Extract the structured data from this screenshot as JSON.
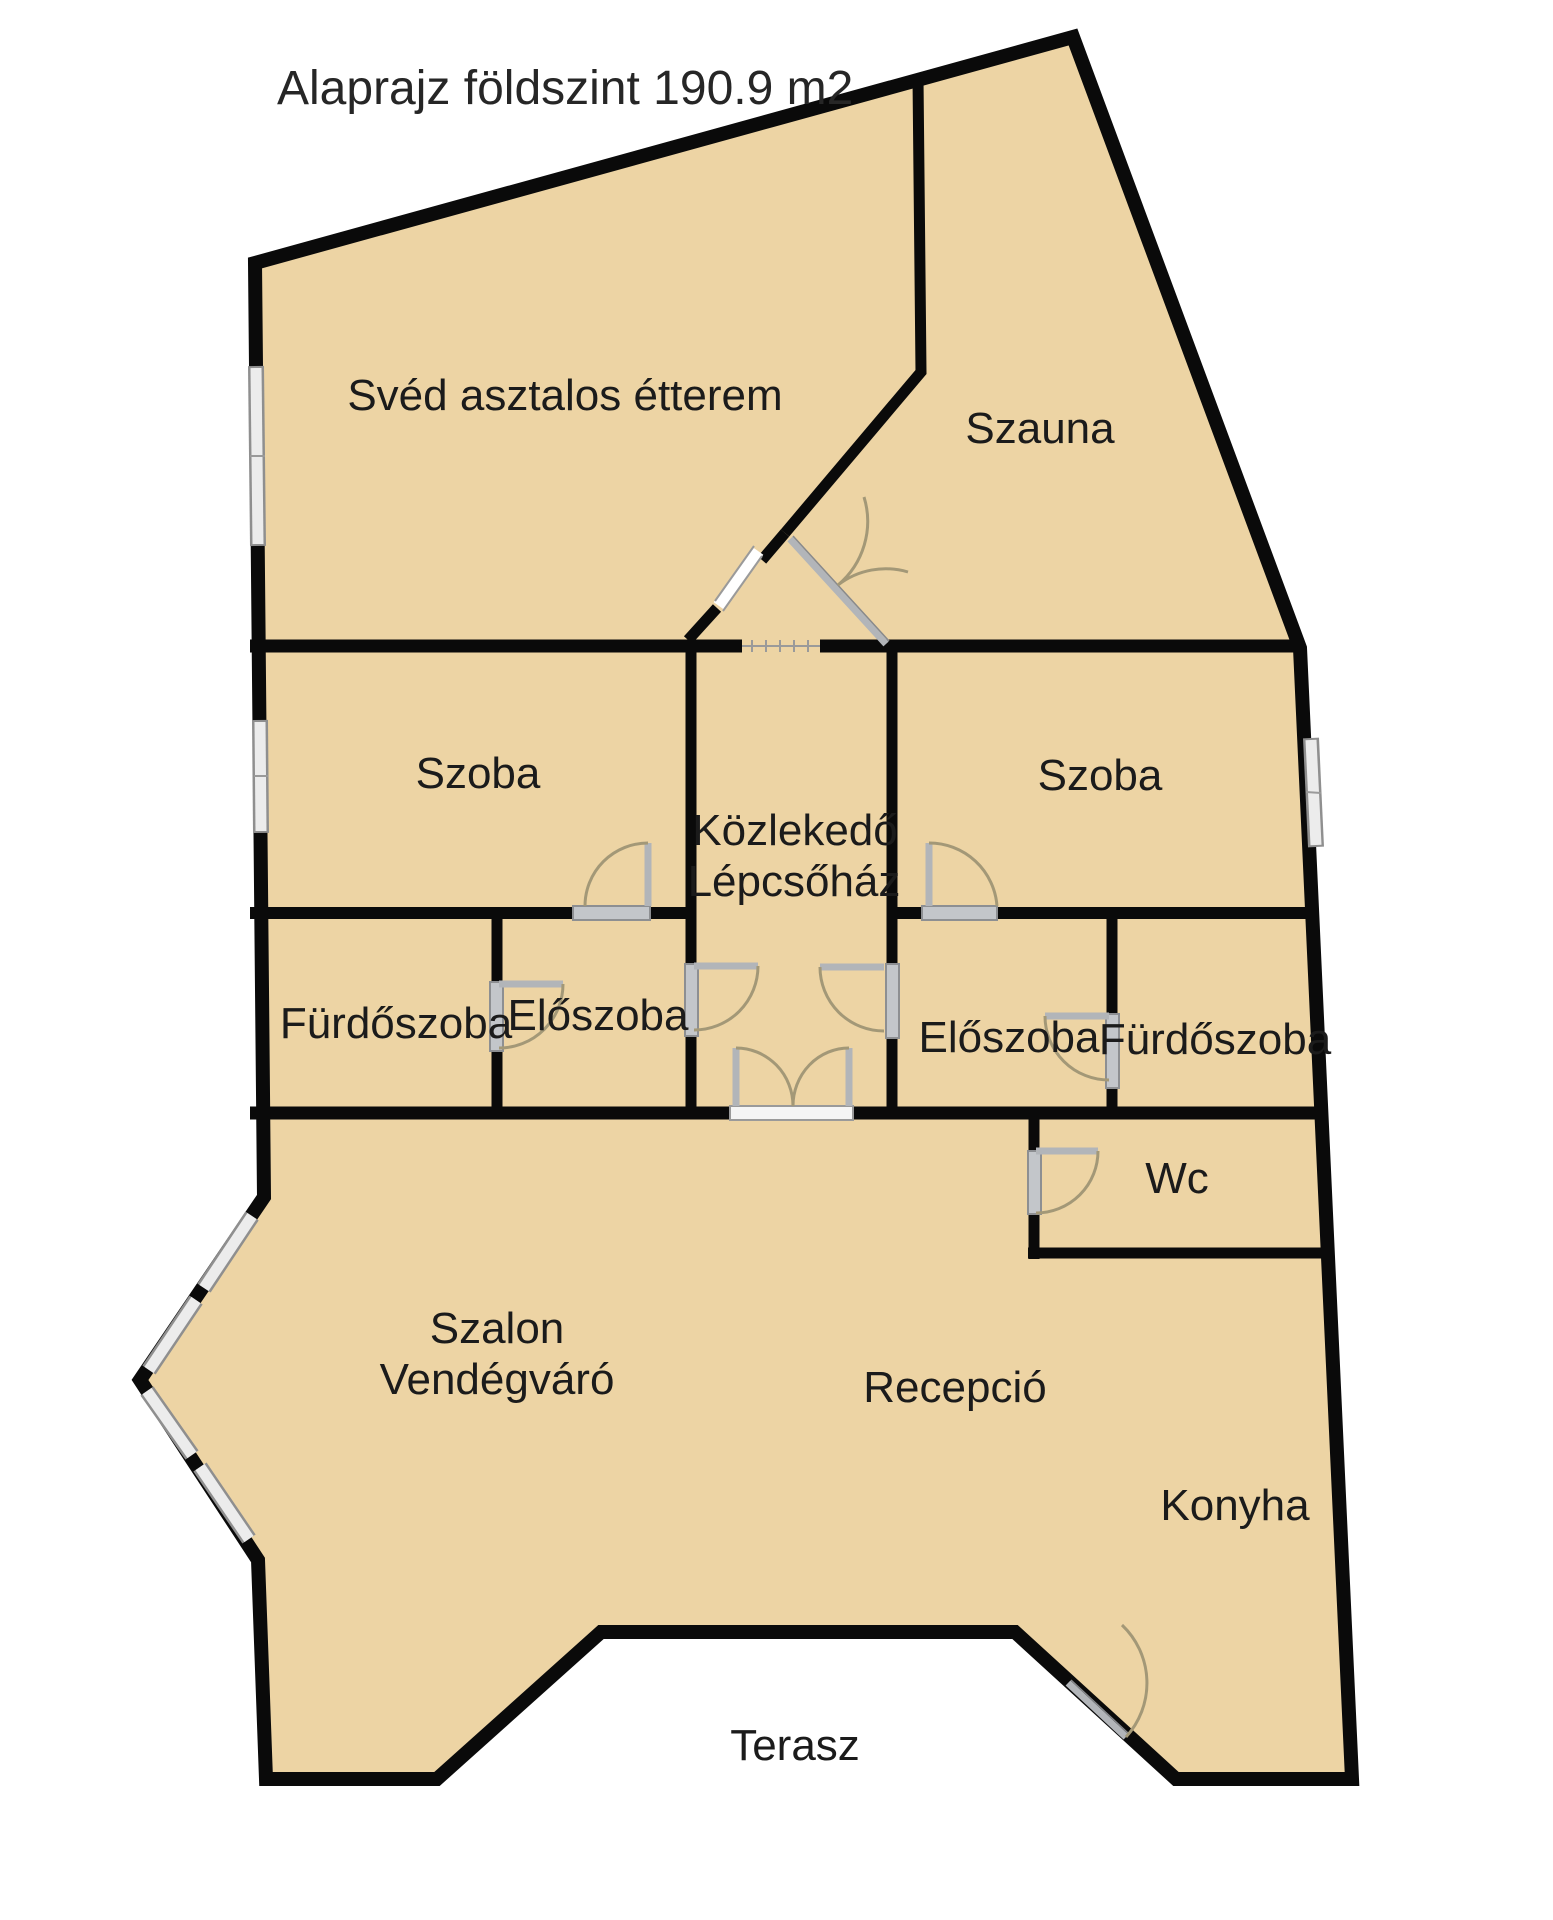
{
  "title": "Alaprajz földszint 190.9 m2",
  "colors": {
    "floor_fill": "#edd4a4",
    "wall": "#0a0a0a",
    "window_gray": "#ececec",
    "door_gray": "#c3c6ca",
    "arc_brown": "#a39877"
  },
  "rooms": {
    "etterem": {
      "label": "Svéd asztalos étterem"
    },
    "szauna": {
      "label": "Szauna"
    },
    "szoba_left": {
      "label": "Szoba"
    },
    "szoba_right": {
      "label": "Szoba"
    },
    "kozlekedo": {
      "label_line1": "Közlekedő",
      "label_line2": "Lépcsőház"
    },
    "furdoszoba_left": {
      "label": "Fürdőszoba"
    },
    "eloszoba_left": {
      "label": "Előszoba"
    },
    "eloszoba_right": {
      "label": "Előszoba"
    },
    "furdoszoba_right": {
      "label": "Fürdőszoba"
    },
    "wc": {
      "label": "Wc"
    },
    "szalon": {
      "label_line1": "Szalon",
      "label_line2": "Vendégváró"
    },
    "recepcio": {
      "label": "Recepció"
    },
    "konyha": {
      "label": "Konyha"
    },
    "terasz": {
      "label": "Terasz"
    }
  }
}
